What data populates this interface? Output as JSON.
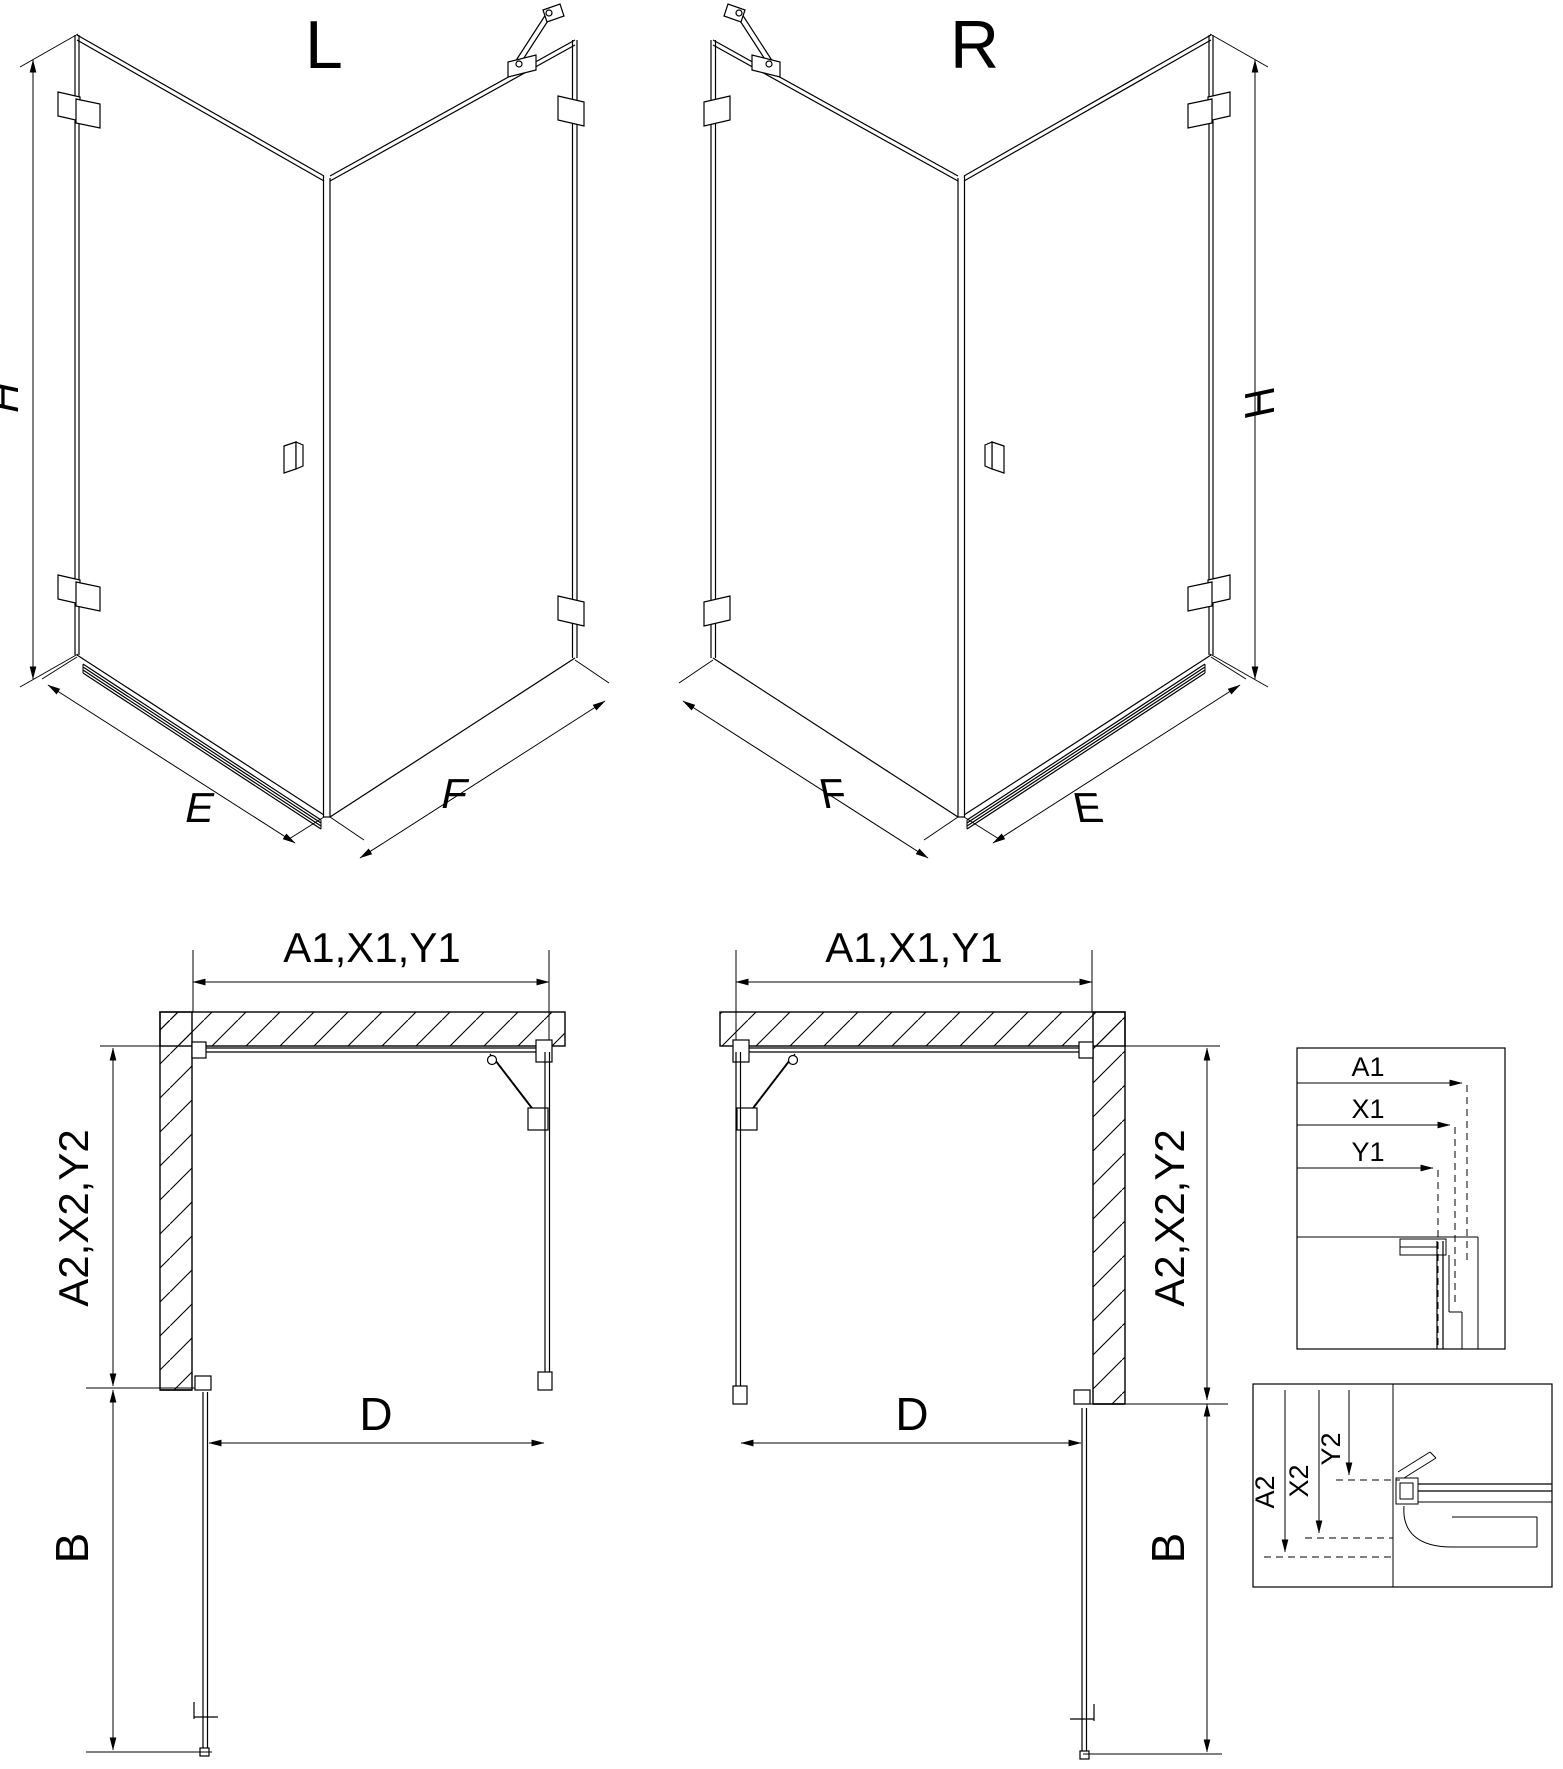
{
  "page": {
    "background": "#ffffff",
    "line_color": "#000000"
  },
  "iso_left": {
    "variant_label": "L",
    "height_label": "H",
    "door_side_label": "E",
    "fixed_side_label": "F"
  },
  "iso_right": {
    "variant_label": "R",
    "height_label": "H",
    "door_side_label": "E",
    "fixed_side_label": "F"
  },
  "plan_left": {
    "width_label": "A1,X1,Y1",
    "depth_label": "A2,X2,Y2",
    "door_opening_label": "D",
    "door_swing_label": "B"
  },
  "plan_right": {
    "width_label": "A1,X1,Y1",
    "depth_label": "A2,X2,Y2",
    "door_opening_label": "D",
    "door_swing_label": "B"
  },
  "detail_width": {
    "labels": [
      "A1",
      "X1",
      "Y1"
    ]
  },
  "detail_depth": {
    "labels": [
      "A2",
      "X2",
      "Y2"
    ]
  }
}
